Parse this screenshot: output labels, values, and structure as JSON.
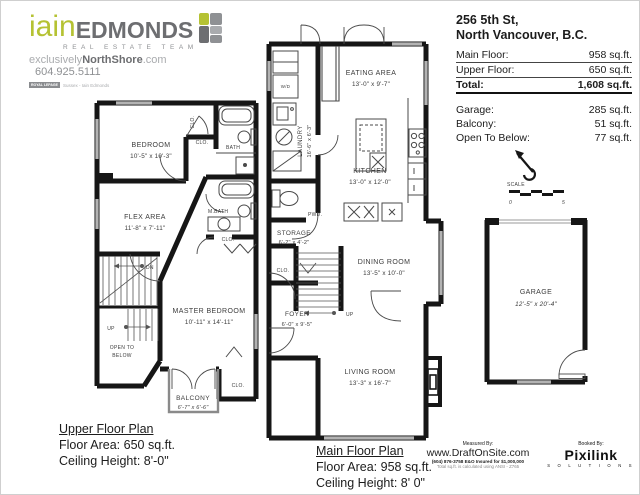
{
  "logo": {
    "name_first": "iain",
    "name_last": "EDMONDS",
    "subtitle": "REAL ESTATE TEAM",
    "tagline_light": "exclusively",
    "tagline_bold": "NorthShore",
    "tagline_suffix": ".com",
    "phone": "604.925.5111",
    "brokerage_brand": "ROYAL LEPAGE",
    "brokerage": "Sussex - Iain Edmonds",
    "colors": {
      "lime": "#b5c233",
      "gray": "#6d6e71",
      "light_gray": "#a9abae"
    }
  },
  "header": {
    "address_line1": "256 5th St,",
    "address_line2": "North Vancouver, B.C.",
    "rows": [
      {
        "label": "Main Floor:",
        "value": "958 sq.ft."
      },
      {
        "label": "Upper Floor:",
        "value": "650 sq.ft."
      }
    ],
    "total": {
      "label": "Total:",
      "value": "1,608 sq.ft."
    },
    "extras": [
      {
        "label": "Garage:",
        "value": "285 sq.ft."
      },
      {
        "label": "Balcony:",
        "value": "51 sq.ft."
      },
      {
        "label": "Open To Below:",
        "value": "77 sq.ft."
      }
    ]
  },
  "upper_plan": {
    "caption": {
      "title": "Upper Floor Plan",
      "area": "Floor Area: 650 sq.ft.",
      "ceiling": "Ceiling Height: 8'-0\""
    },
    "rooms": {
      "bedroom": {
        "name": "BEDROOM",
        "dims": "10'-5\" x 10'-3\""
      },
      "flex": {
        "name": "FLEX AREA",
        "dims": "11'-8\" x 7'-11\""
      },
      "master": {
        "name": "MASTER BEDROOM",
        "dims": "10'-11\" x 14'-11\""
      },
      "balcony": {
        "name": "BALCONY",
        "dims": "6'-7\" x 6'-6\""
      }
    },
    "labels": {
      "clo": "CLO.",
      "bath": "BATH",
      "mbath": "M.BATH",
      "dn": "DN",
      "up": "UP",
      "open_below_1": "OPEN TO",
      "open_below_2": "BELOW"
    }
  },
  "main_plan": {
    "caption": {
      "title": "Main Floor Plan",
      "area": "Floor Area: 958 sq.ft.",
      "ceiling": "Ceiling Height: 8' 0\""
    },
    "rooms": {
      "laundry": {
        "name": "LAUNDRY",
        "dims": "16'-6\" x 6'-3\""
      },
      "eating": {
        "name": "EATING AREA",
        "dims": "13'-0\" x 9'-7\""
      },
      "kitchen": {
        "name": "KITCHEN",
        "dims": "13'-0\" x 12'-0\""
      },
      "storage": {
        "name": "STORAGE",
        "dims": "6'-2\" x 4'-2\""
      },
      "dining": {
        "name": "DINING ROOM",
        "dims": "13'-5\" x 10'-0\""
      },
      "foyer": {
        "name": "FOYER",
        "dims": "6'-0\" x 9'-5\""
      },
      "living": {
        "name": "LIVING ROOM",
        "dims": "13'-3\" x 16'-7\""
      }
    },
    "labels": {
      "clo": "CLO.",
      "pwd": "PWD.",
      "wd": "W/D",
      "up": "UP"
    }
  },
  "garage_plan": {
    "name": "GARAGE",
    "dims": "12'-5\" x 20'-4\"",
    "scale_label": "SCALE",
    "scale_start": "0",
    "scale_end": "5"
  },
  "footer": {
    "measured_by": "Measured By:",
    "site": "www.DraftOnSite.com",
    "phone_line": "(604) 876-3758  E&O Insured for $1,000,000",
    "ansi_line": "Total sq.ft. is calculated using ANSI - Z765",
    "booked_by": "Booked By:",
    "brand": "Pixilink",
    "brand_sub": "S O L U T I O N S"
  }
}
